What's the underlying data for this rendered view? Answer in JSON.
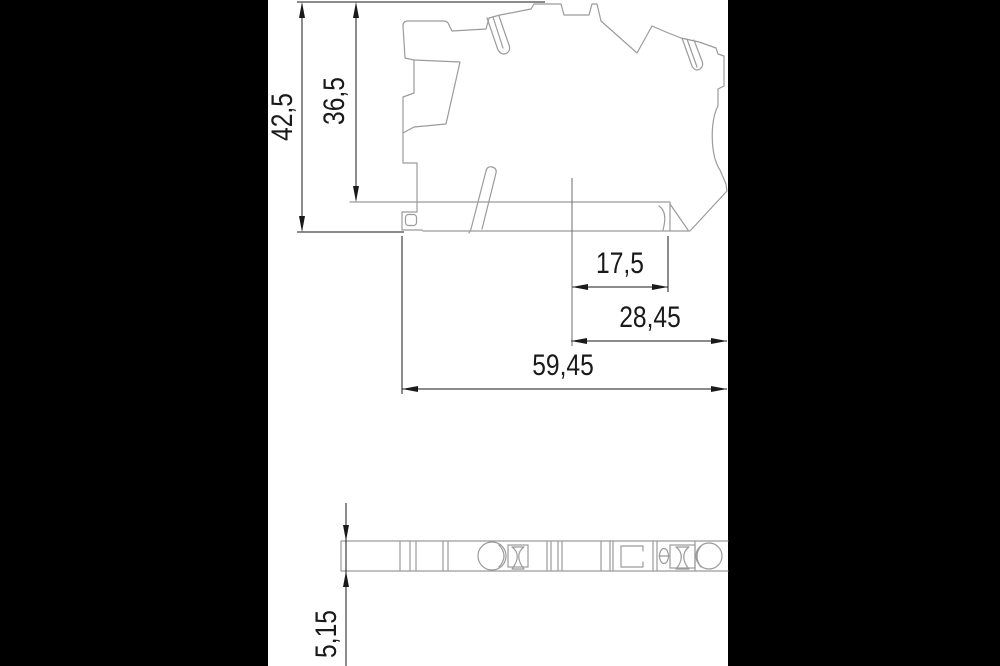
{
  "drawing": {
    "type": "technical-dimension-drawing",
    "views": {
      "side_view": "terminal block side profile",
      "top_view": "terminal block top strip"
    },
    "dimensions": {
      "total_height": "42,5",
      "upper_height": "36,5",
      "inner_width": "17,5",
      "mid_width": "28,45",
      "total_width": "59,45",
      "thickness": "5,15"
    },
    "colors": {
      "background": "#000000",
      "paper": "#ffffff",
      "dimension_lines": "#1a1a1a",
      "part_outline": "#9b9b9b"
    }
  }
}
